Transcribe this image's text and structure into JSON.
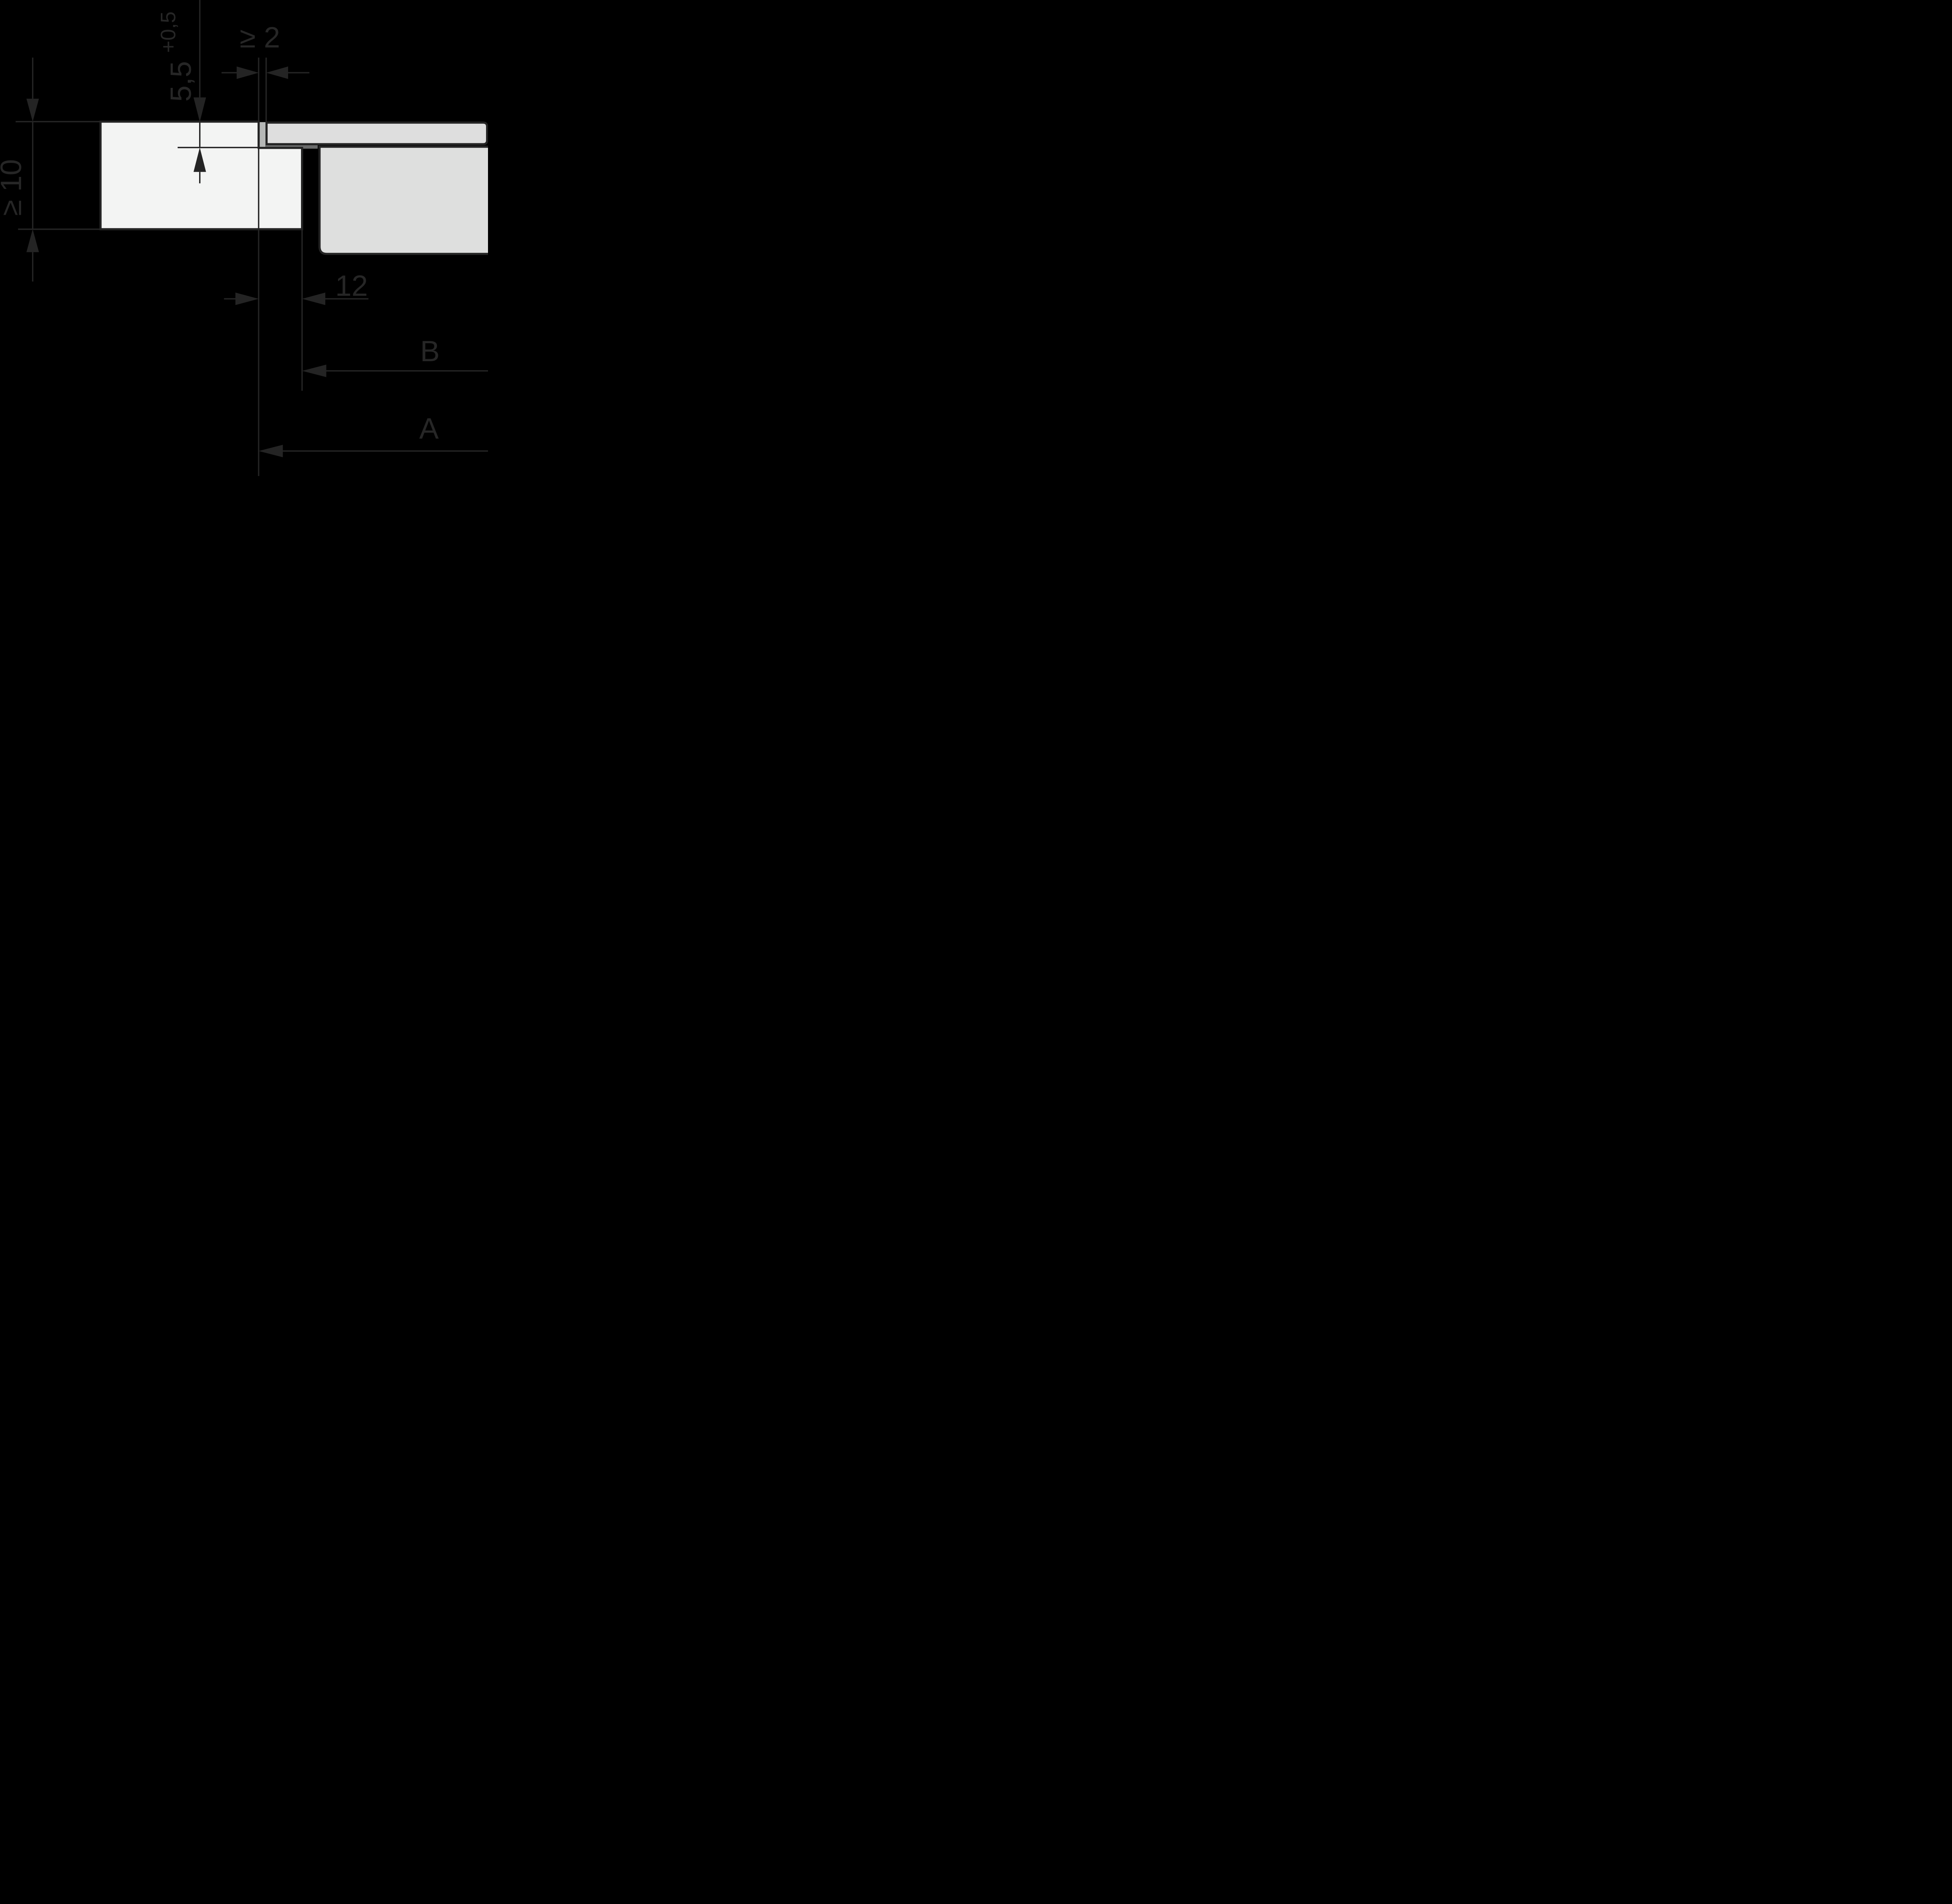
{
  "drawing": {
    "kind": "installation-cross-section",
    "dimensions": {
      "recess_depth": {
        "value": "5,5",
        "tolerance": "+0,5"
      },
      "joint_gap": {
        "value": "≥ 2"
      },
      "min_clearance_below": {
        "value": "≥ 10"
      },
      "ledge_width": {
        "value": "12"
      },
      "cutout_width_label": {
        "value": "B"
      },
      "recess_width_label": {
        "value": "A"
      }
    },
    "colors": {
      "background": "#000000",
      "line": "#242424",
      "text": "#262626",
      "worktop_fill": "#f3f4f3",
      "glass_fill": "#dedede",
      "appliance_fill": "#dedfde",
      "joint_filler_fill": "#b5b7b6",
      "seal_strip_fill": "#6a6b6b"
    }
  }
}
